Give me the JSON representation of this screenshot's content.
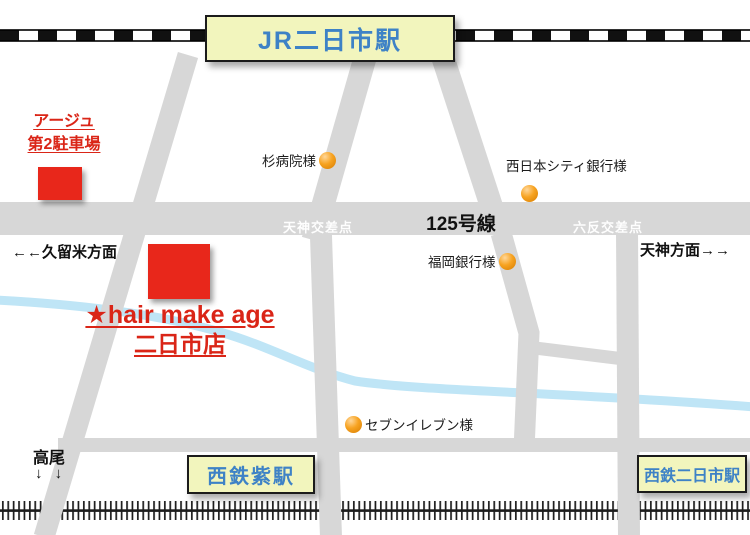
{
  "map": {
    "stations": {
      "jr": "JR二日市駅",
      "murasaki": "西鉄紫駅",
      "nishitetsu_futsukaichi": "西鉄二日市駅"
    },
    "destination": {
      "parking_line1": "アージュ",
      "parking_line2": "第2駐車場",
      "salon_line1": "★hair make age",
      "salon_line2": "二日市店"
    },
    "landmarks": {
      "hospital": "杉病院様",
      "city_bank": "西日本シティ銀行様",
      "fukuoka_bank": "福岡銀行様",
      "seven_eleven": "セブンイレブン様"
    },
    "roads": {
      "route_label": "125号線",
      "crossing_tenjin": "天神交差点",
      "crossing_rokutan": "六反交差点"
    },
    "directions": {
      "kurume": "←←久留米方面",
      "tenjin": "天神方面→→",
      "takao": "高尾",
      "takao_arrows": "↓ ↓"
    },
    "colors": {
      "road_gray": "#d7d7d7",
      "river_blue": "#bfe5f6",
      "highlight_red": "#e8271b",
      "station_fill": "#f2f5bd",
      "station_text": "#3e82c6",
      "landmark_orange": "#f7a321"
    }
  }
}
